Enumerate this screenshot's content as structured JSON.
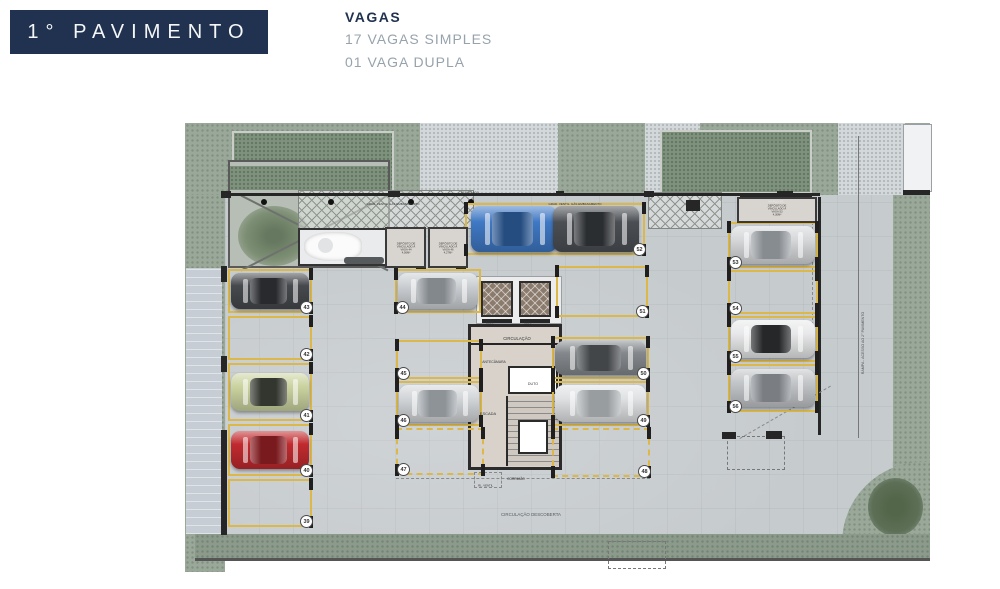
{
  "title": "1° PAVIMENTO",
  "legend": {
    "heading": "VAGAS",
    "items": [
      "17 VAGAS SIMPLES",
      "01 VAGA DUPLA"
    ]
  },
  "palette": {
    "header_navy": "#20324f",
    "legend_gray": "#97a3ac",
    "spot_yellow": "#dcb84a",
    "slab_gray": "#c6cbce",
    "grass_green": "#9aa899",
    "wall_black": "#262626"
  },
  "plan": {
    "spots": [
      {
        "n": "43",
        "x": 228,
        "y": 269,
        "w": 84,
        "h": 44,
        "badge": "br",
        "ticks": "R",
        "car": {
          "body": "#46494d",
          "roof": "#2f3135"
        }
      },
      {
        "n": "42",
        "x": 228,
        "y": 316,
        "w": 84,
        "h": 44,
        "badge": "br",
        "ticks": "R"
      },
      {
        "n": "41",
        "x": 228,
        "y": 363,
        "w": 84,
        "h": 58,
        "badge": "br",
        "ticks": "R",
        "car": {
          "body": "#cbd3a0",
          "roof": "#3c3f37"
        }
      },
      {
        "n": "40",
        "x": 228,
        "y": 424,
        "w": 84,
        "h": 52,
        "badge": "br",
        "ticks": "R",
        "car": {
          "body": "#c02a2e",
          "roof": "#8e1f24"
        }
      },
      {
        "n": "39",
        "x": 228,
        "y": 479,
        "w": 84,
        "h": 48,
        "badge": "br",
        "ticks": "R"
      },
      {
        "n": "44",
        "x": 395,
        "y": 269,
        "w": 86,
        "h": 44,
        "badge": "bl",
        "ticks": "L",
        "car": {
          "body": "#ccd0d3",
          "roof": "#9aa0a5"
        }
      },
      {
        "n": "45",
        "x": 396,
        "y": 340,
        "w": 86,
        "h": 39,
        "badge": "bl",
        "ticks": "LR"
      },
      {
        "n": "46",
        "x": 396,
        "y": 381,
        "w": 86,
        "h": 45,
        "badge": "bl",
        "ticks": "LR",
        "car": {
          "body": "#d3d6d9",
          "roof": "#a7adb2"
        }
      },
      {
        "n": "47",
        "x": 396,
        "y": 428,
        "w": 88,
        "h": 47,
        "badge": "bl",
        "ticks": "LR",
        "dashed": true
      },
      {
        "n": "52",
        "x": 465,
        "y": 203,
        "w": 180,
        "h": 52,
        "badge": "br",
        "ticks": "LR",
        "double": true,
        "cars": [
          {
            "body": "#3f78c4",
            "roof": "#2c5a96"
          },
          {
            "body": "#4b4f54",
            "roof": "#33363a"
          }
        ]
      },
      {
        "n": "51",
        "x": 556,
        "y": 266,
        "w": 92,
        "h": 51,
        "badge": "br",
        "ticks": "LR"
      },
      {
        "n": "50",
        "x": 552,
        "y": 337,
        "w": 97,
        "h": 42,
        "badge": "br",
        "ticks": "LR",
        "car": {
          "body": "#84888c",
          "roof": "#4e5256"
        }
      },
      {
        "n": "49",
        "x": 552,
        "y": 381,
        "w": 97,
        "h": 45,
        "badge": "br",
        "ticks": "LR",
        "car": {
          "body": "#e0e2e4",
          "roof": "#b3b8bc"
        }
      },
      {
        "n": "48",
        "x": 552,
        "y": 428,
        "w": 98,
        "h": 49,
        "badge": "br",
        "ticks": "LR",
        "dashed": true
      },
      {
        "n": "53",
        "x": 728,
        "y": 222,
        "w": 90,
        "h": 46,
        "badge": "bl",
        "ticks": "LR",
        "car": {
          "body": "#d6d8da",
          "roof": "#9fa5aa"
        }
      },
      {
        "n": "54",
        "x": 728,
        "y": 270,
        "w": 90,
        "h": 44,
        "badge": "bl",
        "ticks": "LR"
      },
      {
        "n": "55",
        "x": 728,
        "y": 316,
        "w": 90,
        "h": 46,
        "badge": "bl",
        "ticks": "LR",
        "car": {
          "body": "#e8e9ea",
          "roof": "#2c2e30"
        }
      },
      {
        "n": "56",
        "x": 728,
        "y": 364,
        "w": 90,
        "h": 48,
        "badge": "bl",
        "ticks": "LR",
        "car": {
          "body": "#c3c6c9",
          "roof": "#8f9499"
        }
      }
    ],
    "deposits": [
      {
        "x": 385,
        "y": 227,
        "w": 41,
        "h": 41,
        "text": "DEPÓSITO DE\nVINCULADO À\nVAGA 44\n4,56M²"
      },
      {
        "x": 428,
        "y": 227,
        "w": 40,
        "h": 41,
        "text": "DEPÓSITO DE\nVINCULADO À\nVAGA 46\n4,27M²"
      },
      {
        "x": 737,
        "y": 197,
        "w": 80,
        "h": 26,
        "text": "DEPÓSITO DE\nVINCULADO À\nVAGA 53\n4,30M²"
      }
    ],
    "labels": [
      {
        "t": "CIRCULAÇÃO",
        "x": 517,
        "y": 334,
        "s": 4.2
      },
      {
        "t": "ANTECÂMARA",
        "x": 494,
        "y": 357,
        "s": 3.4
      },
      {
        "t": "DUTO",
        "x": 533,
        "y": 379,
        "s": 3.6
      },
      {
        "t": "ESCADA",
        "x": 488,
        "y": 409,
        "s": 4
      },
      {
        "t": "ELEV.",
        "x": 490,
        "y": 318,
        "s": 2.8
      },
      {
        "t": "ELEV.",
        "x": 528,
        "y": 318,
        "s": 2.8
      },
      {
        "t": "CORRIMÃO",
        "x": 516,
        "y": 474,
        "s": 3.2
      },
      {
        "t": "RL. VENTIL.",
        "x": 486,
        "y": 481,
        "s": 2.8
      },
      {
        "t": "CIRCULAÇÃO DESCOBERTA",
        "x": 531,
        "y": 510,
        "s": 4.4,
        "c": "#565b5f"
      },
      {
        "t": "GRAD. VENTIL. GÁS EMBASAMENTO",
        "x": 393,
        "y": 199,
        "s": 3
      },
      {
        "t": "GRAD. VENTIL. GÁS EMBASAMENTO",
        "x": 575,
        "y": 199,
        "s": 3
      },
      {
        "t": "MARQUISE",
        "x": 776,
        "y": 197,
        "s": 2.8,
        "c": "#e8e8e8"
      },
      {
        "t": "PERGOLADO",
        "x": 470,
        "y": 188,
        "s": 2.8,
        "c": "#444444"
      },
      {
        "t": "RAMPA - ACESSO AO 2° PAVIMENTO",
        "x": 863,
        "y": 338,
        "s": 3.6,
        "r": -90,
        "c": "#555555"
      }
    ]
  }
}
